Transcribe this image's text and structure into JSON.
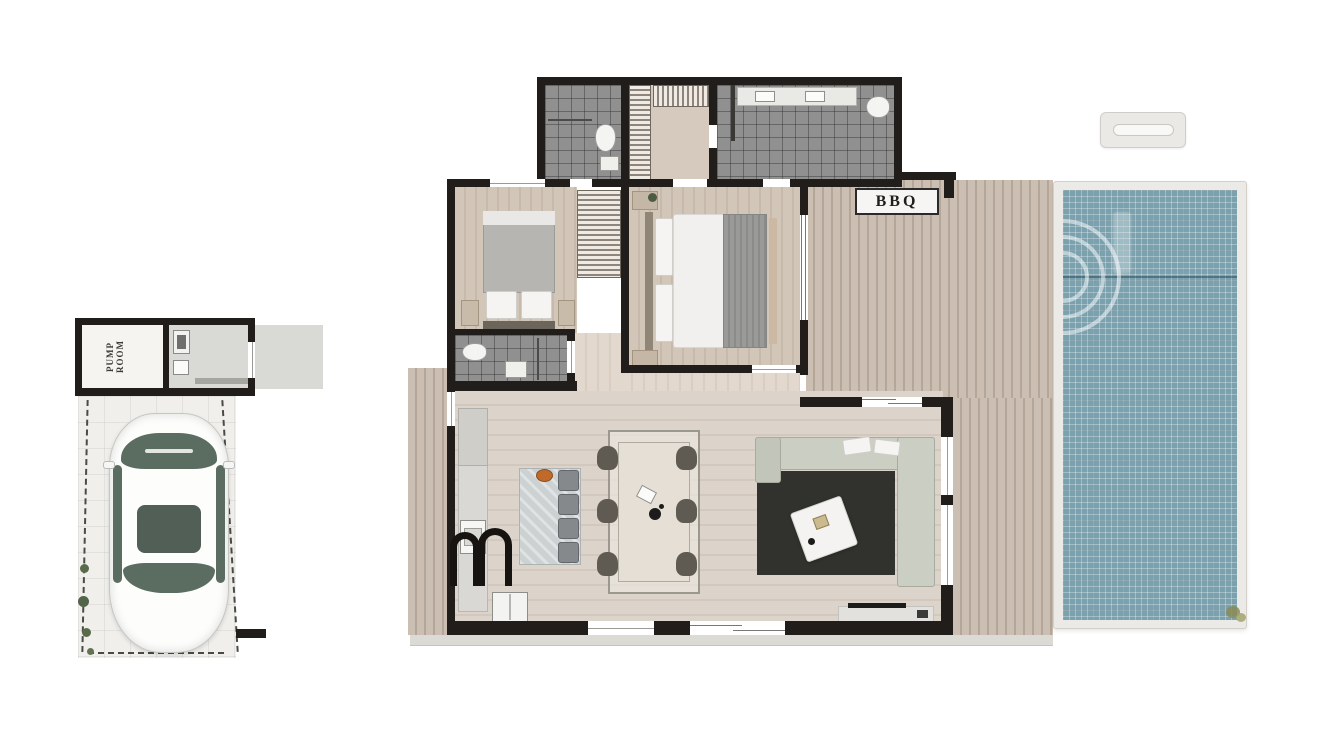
{
  "labels": {
    "pump_room": "PUMP ROOM",
    "bbq": "BBQ"
  },
  "colors": {
    "wall": "#201d1a",
    "deck": "#cbbeb2",
    "deck_stripe": "#b5a698",
    "interior_floor": "#dcd3ca",
    "bedroom_floor": "#d2c6b9",
    "tile": "#909090",
    "pool_water": "#7ba1ae",
    "pool_frame": "#eceae6",
    "rug": "#31312d",
    "sofa": "#cbcec2",
    "car_glass": "#5b6c60",
    "accent_bowl": "#bf6a2a",
    "label_bg": "#f6f5f3"
  }
}
